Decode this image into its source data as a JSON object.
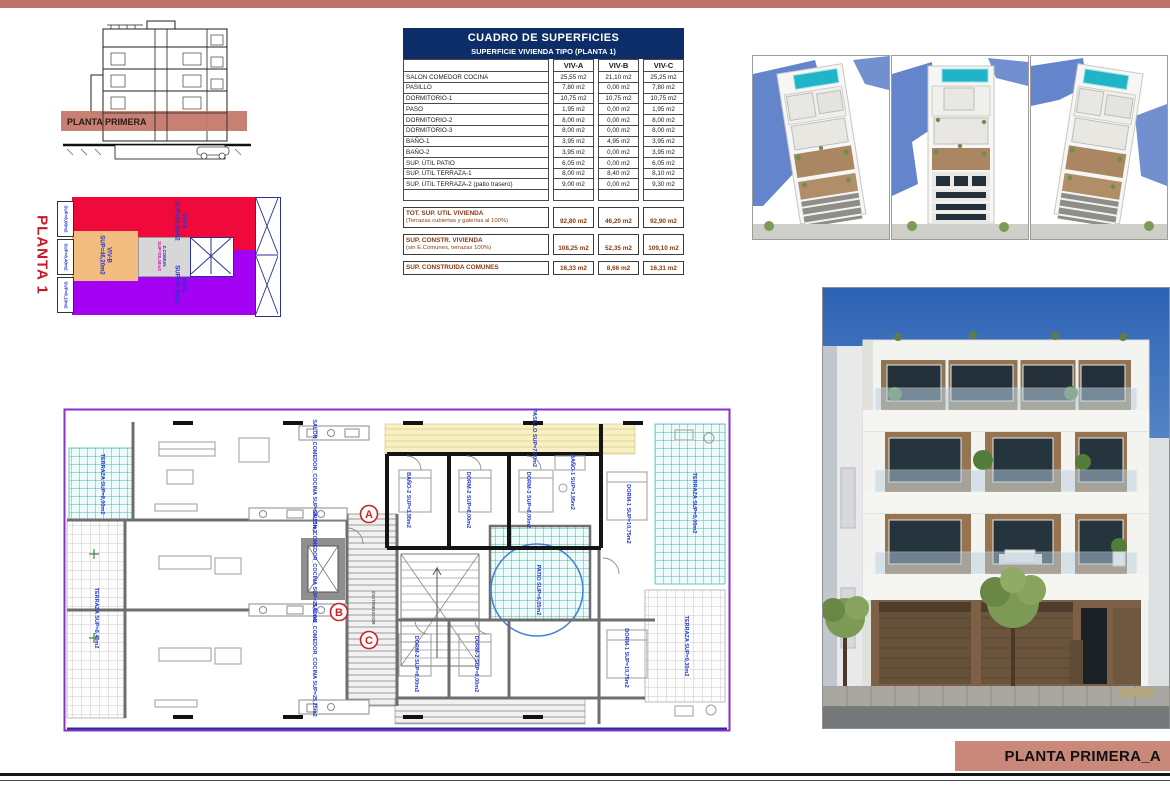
{
  "colors": {
    "accent_salmon": "#bd7168",
    "band_salmon": "#c5796d",
    "footer_salmon": "#c9887a",
    "table_header_navy": "#0c2d67",
    "totals_brown": "#8a3a12",
    "viv_a_red": "#f00a3c",
    "viv_b_orange": "#f3bd7f",
    "viv_c_purple": "#a402f2",
    "zcomun_gray": "#d7d7d7",
    "plan_label_blue": "#2136d4",
    "terrace_teal": "#49b8b8",
    "marker_red": "#cc2222"
  },
  "section_drawing": {
    "band_label": "PLANTA PRIMERA"
  },
  "color_plan": {
    "title": "PLANTA 1",
    "viv_a": {
      "name": "VIV-A",
      "sup": "SUP=92,80m2"
    },
    "viv_b": {
      "name": "VIV-B",
      "sup": "SUP=46,20m2"
    },
    "viv_c": {
      "name": "VIV-C",
      "sup": "SUP=92,90m2"
    },
    "zcomun": {
      "name": "Z.COMUN",
      "sup": "SUP=28,48m2"
    },
    "terraza_labels": [
      "SUP=8,00m2",
      "SUP=8,40m2",
      "SUP=8,10m2"
    ]
  },
  "table": {
    "title": "CUADRO DE SUPERFICIES",
    "subtitle": "SUPERFICIE VIVIENDA TIPO  (PLANTA 1)",
    "columns": [
      "VIV-A",
      "VIV-B",
      "VIV-C"
    ],
    "rows": [
      [
        "SALON COMEDOR COCINA",
        "25,55 m2",
        "21,10 m2",
        "25,25 m2"
      ],
      [
        "PASILLO",
        "7,80 m2",
        "0,00 m2",
        "7,80 m2"
      ],
      [
        "DORMITORIO-1",
        "10,75 m2",
        "10,75 m2",
        "10,75 m2"
      ],
      [
        "PASO",
        "1,95 m2",
        "0,00 m2",
        "1,95 m2"
      ],
      [
        "DORMITORIO-2",
        "8,00 m2",
        "0,00 m2",
        "8,00 m2"
      ],
      [
        "DORMITORIO-3",
        "8,00 m2",
        "0,00 m2",
        "8,00 m2"
      ],
      [
        "BAÑO-1",
        "3,95 m2",
        "4,95 m2",
        "3,95 m2"
      ],
      [
        "BAÑO-2",
        "3,95 m2",
        "0,00 m2",
        "3,95 m2"
      ],
      [
        "SUP. ÚTIL PATIO",
        "6,05 m2",
        "0,00 m2",
        "6,05 m2"
      ],
      [
        "SUP. ÚTIL TERRAZA-1",
        "8,00 m2",
        "8,40 m2",
        "8,10 m2"
      ],
      [
        "SUP. ÚTIL TERRAZA-2 (patio trasero)",
        "9,00 m2",
        "0,00 m2",
        "9,30 m2"
      ]
    ],
    "totals": [
      {
        "label": "TOT. SUP. UTIL VIVIENDA",
        "sublabel": "(Terrazas cubiertas y galerías al 100%)",
        "values": [
          "92,80 m2",
          "46,20 m2",
          "92,90 m2"
        ]
      },
      {
        "label": "SUP. CONSTR. VIVIENDA",
        "sublabel": "(sin E.Comunes, terrazas 100%)",
        "values": [
          "108,25 m2",
          "52,35 m2",
          "109,10 m2"
        ]
      },
      {
        "label": "SUP. CONSTRUIDA COMUNES",
        "sublabel": "",
        "values": [
          "16,33 m2",
          "8,66 m2",
          "16,31 m2"
        ]
      }
    ]
  },
  "floor_plan": {
    "markers": [
      "A",
      "B",
      "C"
    ],
    "labels": {
      "salon_a": "SALON_COMEDOR_COCINA SUP=25,55m2",
      "salon_b": "SALON_COMEDOR_COCINA SUP=21,10m2",
      "salon_c": "SALON_COMEDOR_COCINA SUP=25,25m2",
      "pasillo": "PASILLO SUP=7,80m2",
      "dorm1_a": "DORM-1 SUP=10,75m2",
      "dorm2_a": "DORM-2 SUP=8,00m2",
      "dorm3_a": "DORM-3 SUP=8,00m2",
      "bano1": "BAÑO-1 SUP=3,95m2",
      "bano2": "BAÑO-2 SUP=3,95m2",
      "patio": "PATIO SUP=6,05m2",
      "terraza_tl": "TERRAZA SUP=8,00m2",
      "terraza_r": "TERRAZA SUP=9,00m2",
      "terraza_br": "TERRAZA SUP=9,30m2",
      "terraza_l": "TERRAZA SUP=8,40m2",
      "dorm1_c": "DORM-1 SUP=10,75m2",
      "dorm2_c": "DORM-2 SUP=8,00m2",
      "dorm3_c": "DORM-3 SUP=8,00m2",
      "distribuidor": "DISTRIBUIDOR"
    }
  },
  "footer": {
    "label": "PLANTA PRIMERA_A"
  }
}
